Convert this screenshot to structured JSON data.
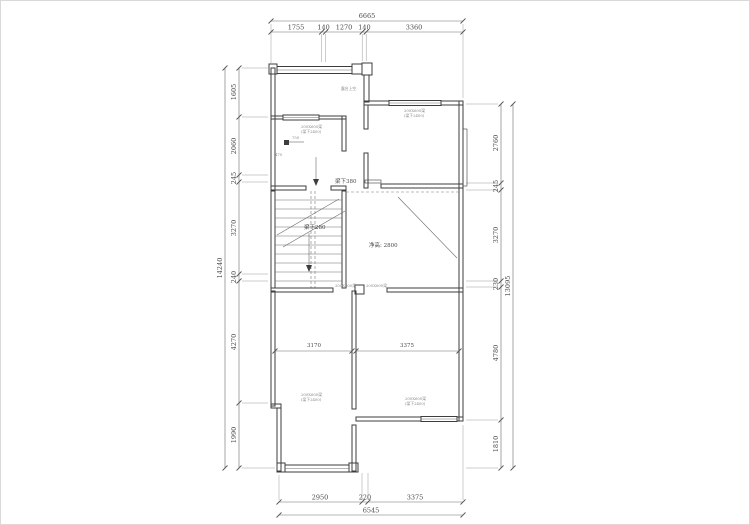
{
  "colors": {
    "wall": "#3d3d3d",
    "dim_line": "#6b6b6b",
    "text": "#4a4a4a",
    "annotation": "#8a8a8a",
    "background": "#ffffff"
  },
  "dims": {
    "top": {
      "total": "6665",
      "segments": [
        "1755",
        "140",
        "1270",
        "140",
        "3360"
      ]
    },
    "left": {
      "total": "14240",
      "segments": [
        "1605",
        "2060",
        "245",
        "3270",
        "240",
        "4270",
        "1990"
      ]
    },
    "right": {
      "total": "13095",
      "segments": [
        "2760",
        "245",
        "3270",
        "230",
        "4780",
        "1810"
      ]
    },
    "bottom": {
      "total": "6545",
      "segments": [
        "2950",
        "220",
        "3375"
      ]
    }
  },
  "room_dims": {
    "left_room": "3170",
    "right_room": "3375"
  },
  "notes": {
    "beam_mid": "梁下380",
    "beam_stair": "梁下280",
    "clear_height": "净高: 2800"
  },
  "micro": {
    "beam_spec": "200X600梁",
    "beam_drop": "(梁下2400)",
    "dim_750": "750",
    "dim_470": "470",
    "terrace": "露台上空"
  }
}
